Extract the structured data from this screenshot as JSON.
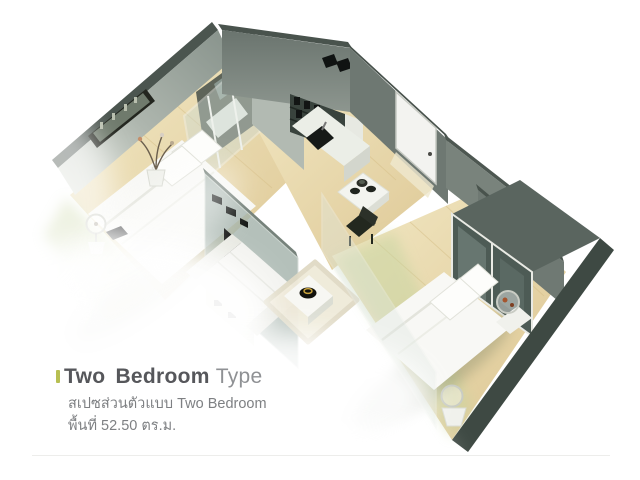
{
  "caption": {
    "accent_color": "#b7bf52",
    "title": "Two Bedroom",
    "title_suffix": "Type",
    "subtitle_thai": "สเปซส่วนตัวแบบ Two Bedroom",
    "area_thai": "พื้นที่ 52.50 ตร.ม."
  },
  "floorplan": {
    "colors": {
      "wall_light": "#9aa49d",
      "wall_mid": "#6e7872",
      "wall_top_cap": "#49534d",
      "wall_darkest": "#3e4943",
      "floor_wood": "#e9d8a9",
      "floor_wood_light": "#f2e8c4",
      "floor_green_wash": "#cbd7a6",
      "glass": "#cfdcd5",
      "furniture_white": "#f8f8f5",
      "dark_accent": "#14171a",
      "bowl_gold": "#c8a23c"
    }
  }
}
